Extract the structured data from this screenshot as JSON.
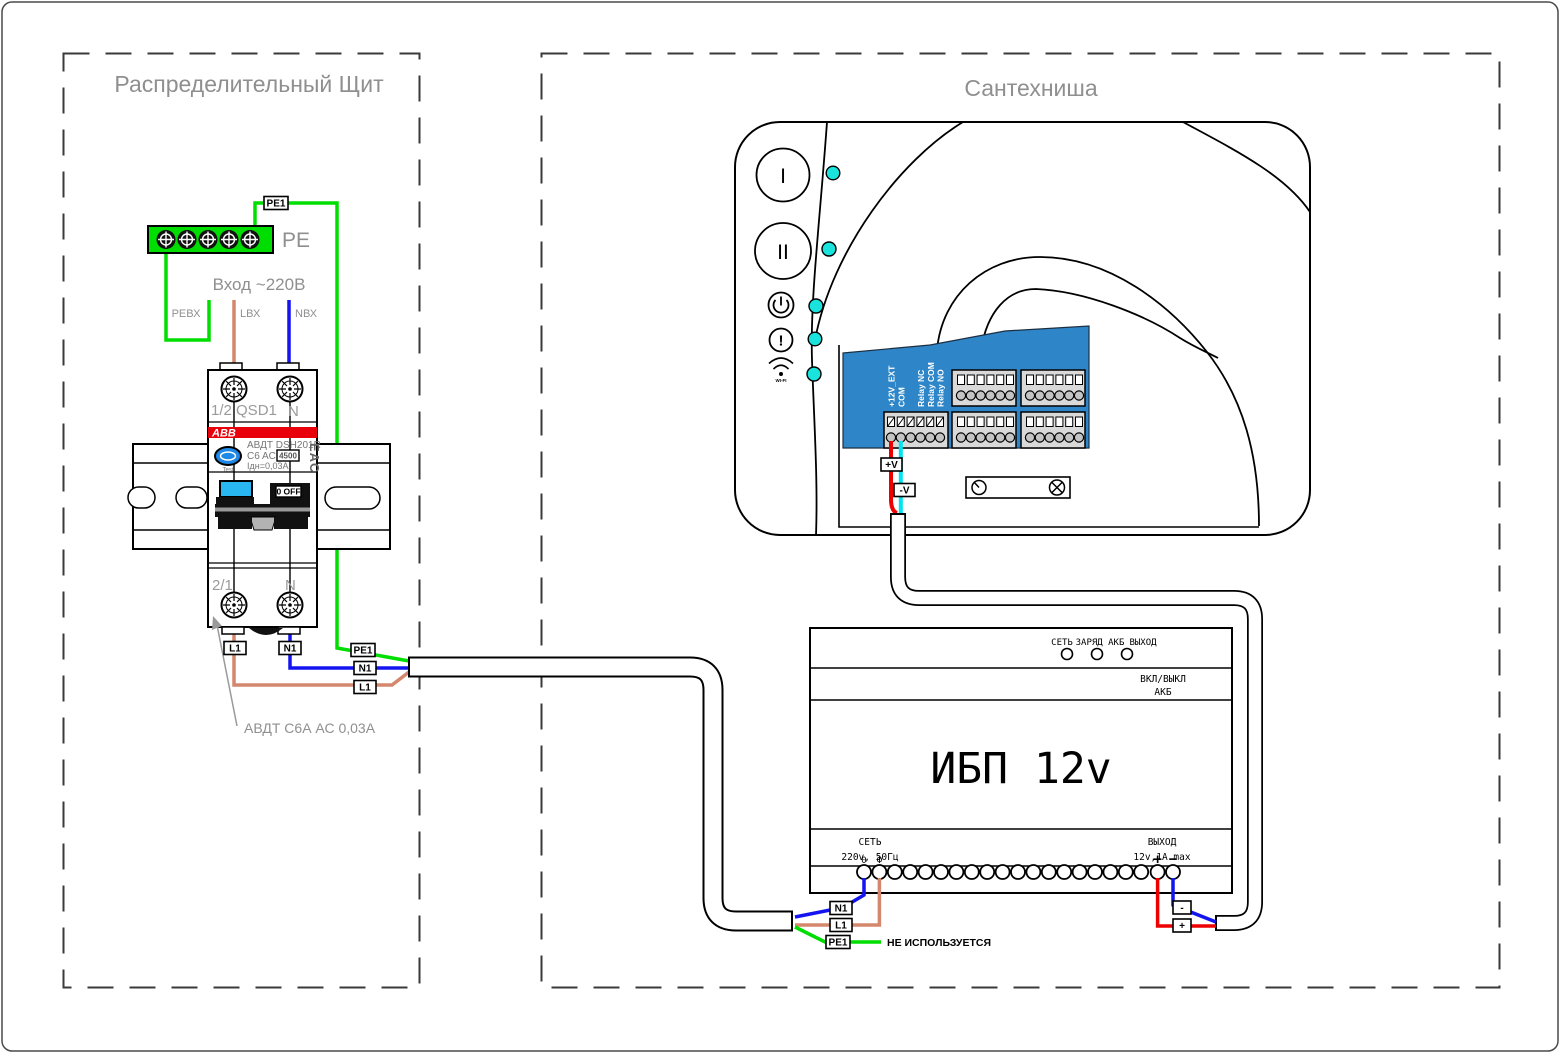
{
  "frame": {
    "left_title": "Распределительный Щит",
    "right_title": "Сантехниша"
  },
  "dist": {
    "pe_bus": "PE",
    "input": "Вход ~220В",
    "in_pe": "PEВХ",
    "in_l": "LВХ",
    "in_n": "NВХ"
  },
  "brk": {
    "brand": "ABB",
    "model": "АВДТ DSH201R",
    "rating": "C6 AC",
    "capacity": "4500",
    "leakage": "Iдн=0,03A",
    "test": "Test",
    "cert": "EAC",
    "tl": "1/2 QSD1",
    "tr": "N",
    "bl": "2/1",
    "br": "N",
    "switch": "0 OFF",
    "note": "АВДТ С6А АС 0,03А"
  },
  "tags": {
    "pe1": "PE1",
    "n1": "N1",
    "l1": "L1",
    "pv": "+V",
    "mv": "-V",
    "p": "+",
    "m": "-"
  },
  "dev": {
    "b1": "I",
    "b2": "II",
    "wifi": "WI-FI",
    "t": [
      "+12V_EXT",
      "COM",
      "Relay NC",
      "Relay COM",
      "Relay NO"
    ]
  },
  "ups": {
    "leds": [
      "СЕТЬ",
      "ЗАРЯД АКБ",
      "ВЫХОД"
    ],
    "sw1": "ВКЛ/ВЫКЛ",
    "sw2": "АКБ",
    "name": "ИБП 12v",
    "in1": "СЕТЬ",
    "in2": "220v, 50Гц",
    "out1": "ВЫХОД",
    "out2": "12v,1A max",
    "t0": "0",
    "tf": "Ф",
    "tp": "+",
    "tm": "−",
    "note": "НЕ ИСПОЛЬЗУЕТСЯ"
  },
  "colors": {
    "wire_pe_green": "#00dd00",
    "wire_n_blue": "#1414f0",
    "wire_l_salmon": "#d4876d",
    "wire_plus_red": "#ee0000",
    "wire_minus_cyan": "#00e5ef",
    "led_cyan": "#19e3dc",
    "panel_blue": "#2e86c8",
    "toggle_blue": "#29b7f2",
    "abb_red": "#e8000b"
  }
}
